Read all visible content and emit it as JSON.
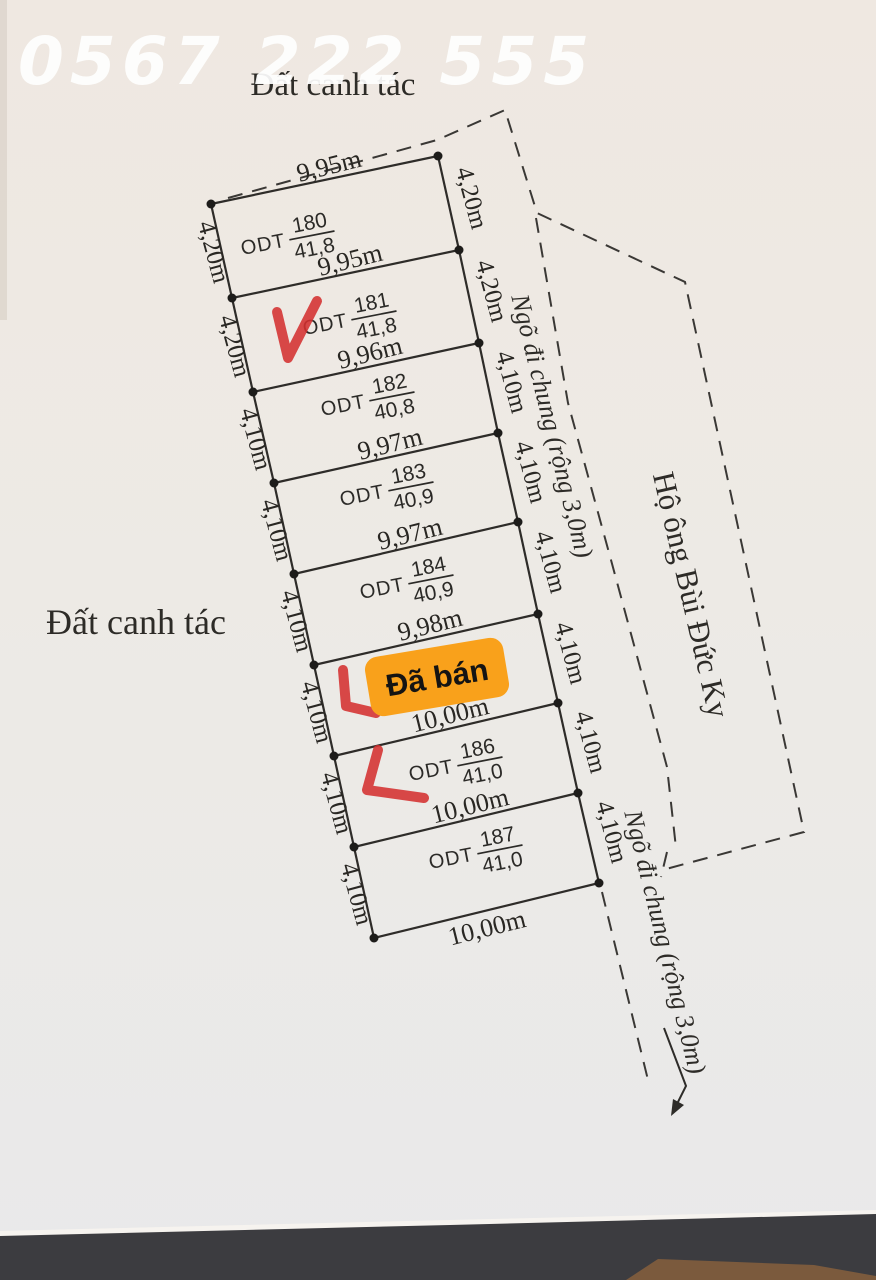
{
  "watermark_phone": "0567 222 555",
  "surroundings": {
    "top": "Đất canh tác",
    "left": "Đất canh tác",
    "alley_upper": "Ngõ đi chung (rộng 3,0m)",
    "alley_lower": "Ngõ đi chung (rộng 3,0m)",
    "right_household": "Hộ ông Bùi Đức Ky"
  },
  "sold_sticker": "Đã bán",
  "plots": [
    {
      "land_type": "ODT",
      "number": "180",
      "area": "41,8"
    },
    {
      "land_type": "ODT",
      "number": "181",
      "area": "41,8"
    },
    {
      "land_type": "ODT",
      "number": "182",
      "area": "40,8"
    },
    {
      "land_type": "ODT",
      "number": "183",
      "area": "40,9"
    },
    {
      "land_type": "ODT",
      "number": "184",
      "area": "40,9"
    },
    {
      "land_type": "ODT",
      "number": "186",
      "area": "41,0"
    },
    {
      "land_type": "ODT",
      "number": "187",
      "area": "41,0"
    }
  ],
  "edge_widths": [
    "9,95m",
    "9,95m",
    "9,96m",
    "9,97m",
    "9,97m",
    "9,98m",
    "10,00m",
    "10,00m",
    "10,00m"
  ],
  "left_depths": [
    "4,20m",
    "4,20m",
    "4,10m",
    "4,10m",
    "4,10m",
    "4,10m",
    "4,10m",
    "4,10m"
  ],
  "right_depths": [
    "4,20m",
    "4,20m",
    "4,10m",
    "4,10m",
    "4,10m",
    "4,10m",
    "4,10m",
    "4,10m"
  ],
  "colors": {
    "paper": "#ece7e1",
    "line": "#2e2c29",
    "sticker_orange": "#f9a11b",
    "annotation_red": "#d43030",
    "watermark_white": "#ffffff",
    "desk_dark": "#3c3c40",
    "desk_wood": "#7b5a3d"
  }
}
